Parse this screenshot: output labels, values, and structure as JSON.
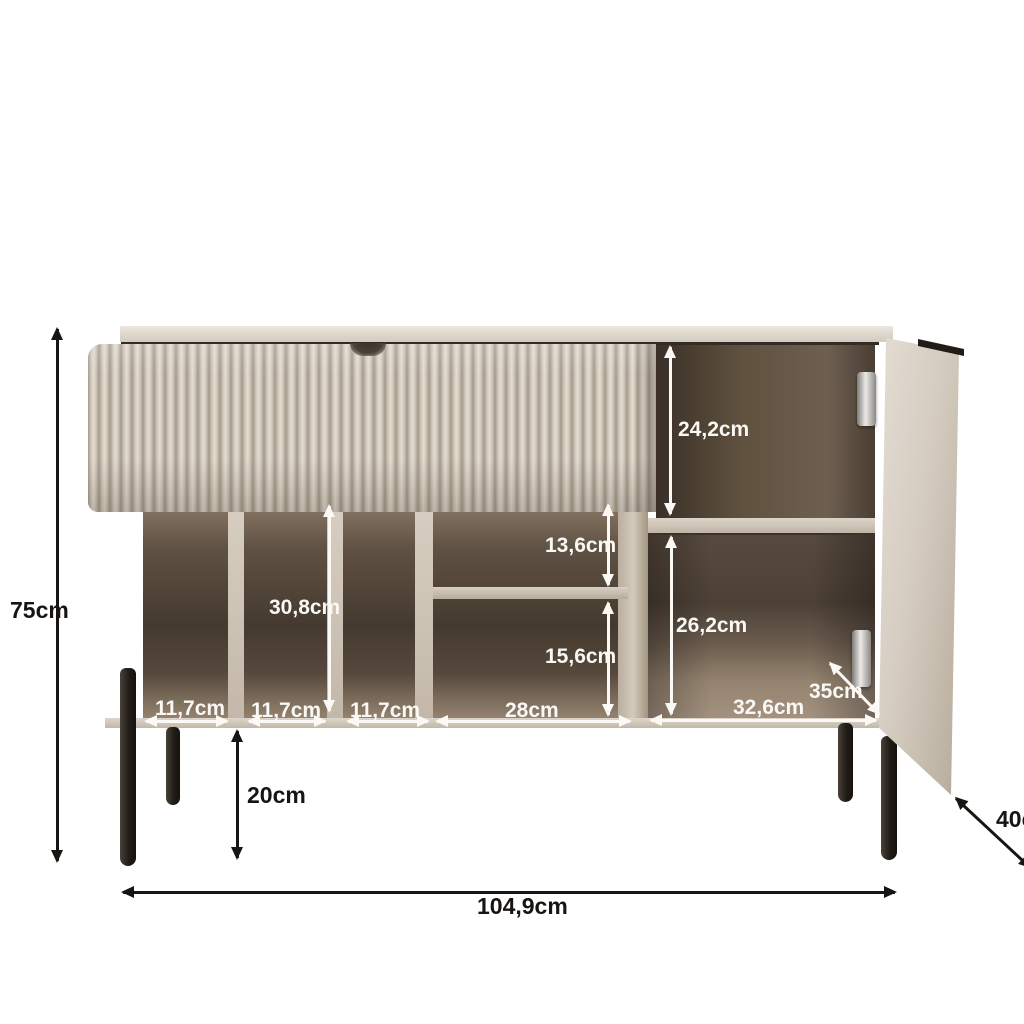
{
  "diagram": {
    "kind": "furniture-dimension-diagram",
    "product": "sideboard with fluted drawer front, open shelves and side door",
    "unit": "cm"
  },
  "labels": {
    "total_height": "75cm",
    "leg_height": "20cm",
    "total_width": "104,9cm",
    "total_depth": "40cm",
    "interior_depth": "35cm",
    "right_upper_height": "24,2cm",
    "right_lower_height": "26,2cm",
    "middle_upper_height": "13,6cm",
    "middle_lower_height": "15,6cm",
    "open_shelf_height": "30,8cm",
    "slot_width_1": "11,7cm",
    "slot_width_2": "11,7cm",
    "slot_width_3": "11,7cm",
    "middle_width": "28cm",
    "right_width": "32,6cm"
  },
  "colors": {
    "body_beige": "#d5cdc1",
    "fluted_highlight": "#e4ddd2",
    "fluted_shadow": "#a59a8b",
    "interior_dark": "#453a2f",
    "interior_floor": "#93826f",
    "legs": "#211c17",
    "dimension_black": "#171411",
    "dimension_white": "#fbf9f5"
  }
}
